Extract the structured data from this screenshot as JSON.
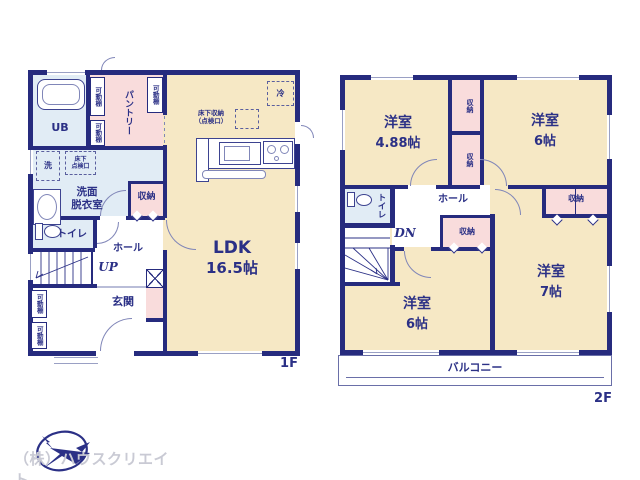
{
  "colors": {
    "wall": "#262b7e",
    "room_cream": "#f6e8c5",
    "closet_pink": "#f9dcdc",
    "wet_area_blue": "#e1ecf5",
    "label_navy": "#2b3086",
    "logo_gray": "#c9cad4"
  },
  "floor1": {
    "label": "1F",
    "ldk_name": "LDK",
    "ldk_size": "16.5帖",
    "pantry": "パントリー",
    "bath": "UB",
    "washroom_l1": "洗面",
    "washroom_l2": "脱衣室",
    "washer": "洗",
    "hatch_l1": "床下",
    "hatch_l2": "点検口",
    "floor_storage_l1": "床下収納",
    "floor_storage_l2": "（点検口）",
    "fridge": "冷",
    "closet": "収納",
    "toilet": "トイレ",
    "hall": "ホール",
    "up": "UP",
    "entrance": "玄関",
    "shelf": "可動棚"
  },
  "floor2": {
    "label": "2F",
    "bedroom_a_name": "洋室",
    "bedroom_a_size": "4.88帖",
    "bedroom_b_name": "洋室",
    "bedroom_b_size": "6帖",
    "bedroom_c_name": "洋室",
    "bedroom_c_size": "6帖",
    "bedroom_d_name": "洋室",
    "bedroom_d_size": "7帖",
    "closet": "収納",
    "toilet": "トイレ",
    "hall": "ホール",
    "dn": "DN",
    "balcony": "バルコニー"
  },
  "footer": {
    "company": "（株）ハウスクリエイト"
  }
}
